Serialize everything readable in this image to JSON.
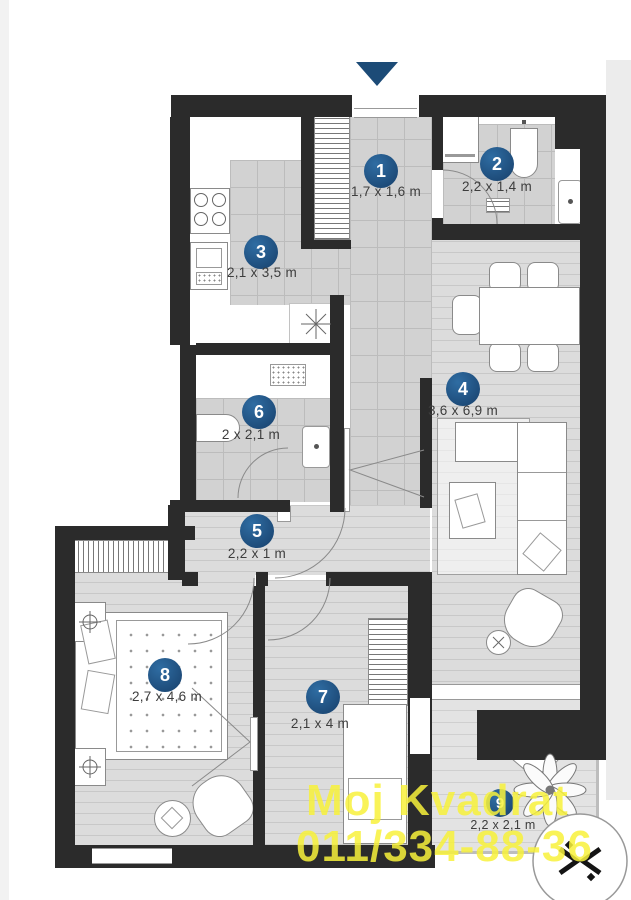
{
  "watermark": {
    "line1": "Moj Kvadrat",
    "line2": "011/334-88-36"
  },
  "rooms": [
    {
      "number": "1",
      "dims": "1,7 x 1,6 m"
    },
    {
      "number": "2",
      "dims": "2,2 x 1,4 m"
    },
    {
      "number": "3",
      "dims": "2,1 x 3,5 m"
    },
    {
      "number": "4",
      "dims": "3,6 x 6,9 m"
    },
    {
      "number": "5",
      "dims": "2,2 x 1 m"
    },
    {
      "number": "6",
      "dims": "2 x 2,1 m"
    },
    {
      "number": "7",
      "dims": "2,1 x 4 m"
    },
    {
      "number": "8",
      "dims": "2,7 x 4,6 m"
    },
    {
      "number": "9",
      "dims": "2,2 x 2,1 m"
    }
  ]
}
